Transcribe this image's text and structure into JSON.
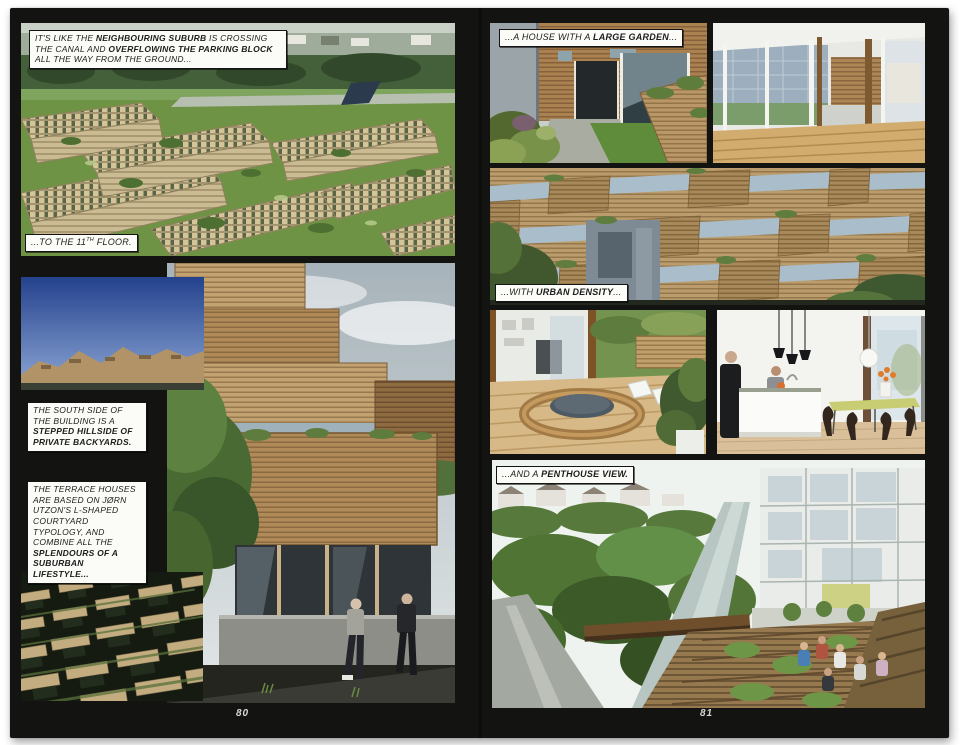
{
  "colors": {
    "spread_bg": "#131311",
    "paper_bg": "#ffffff",
    "caption_bg": "#fbfbf7",
    "caption_border": "#141414",
    "caption_text": "#1c1c1c",
    "page_number": "#d6d6d6"
  },
  "captions": {
    "crossing": {
      "segments": [
        {
          "t": "IT'S LIKE THE "
        },
        {
          "t": "NEIGHBOURING SUBURB",
          "b": true
        },
        {
          "t": " IS CROSSING THE CANAL AND "
        },
        {
          "t": "OVERFLOWING THE PARKING BLOCK",
          "b": true
        },
        {
          "t": " ALL THE WAY FROM THE GROUND..."
        }
      ]
    },
    "floor": {
      "segments": [
        {
          "t": "...TO THE 11"
        },
        {
          "t": "TH",
          "sup": true
        },
        {
          "t": " FLOOR."
        }
      ]
    },
    "south_side": {
      "segments": [
        {
          "t": "THE SOUTH SIDE OF THE BUILDING IS A "
        },
        {
          "t": "STEPPED HILLSIDE OF PRIVATE BACKYARDS.",
          "b": true
        }
      ]
    },
    "terrace": {
      "segments": [
        {
          "t": "THE TERRACE HOUSES ARE BASED ON JØRN UTZON'S L-SHAPED COURTYARD TYPOLOGY, AND COMBINE ALL THE "
        },
        {
          "t": "SPLENDOURS OF A SUBURBAN LIFESTYLE...",
          "b": true
        }
      ]
    },
    "garden": {
      "segments": [
        {
          "t": "...A HOUSE WITH A "
        },
        {
          "t": "LARGE GARDEN",
          "b": true
        },
        {
          "t": "..."
        }
      ]
    },
    "density": {
      "segments": [
        {
          "t": "...WITH "
        },
        {
          "t": "URBAN DENSITY",
          "b": true
        },
        {
          "t": "..."
        }
      ]
    },
    "penthouse": {
      "segments": [
        {
          "t": "...AND A "
        },
        {
          "t": "PENTHOUSE VIEW.",
          "b": true
        }
      ]
    }
  },
  "page_numbers": {
    "left": "80",
    "right": "81"
  }
}
